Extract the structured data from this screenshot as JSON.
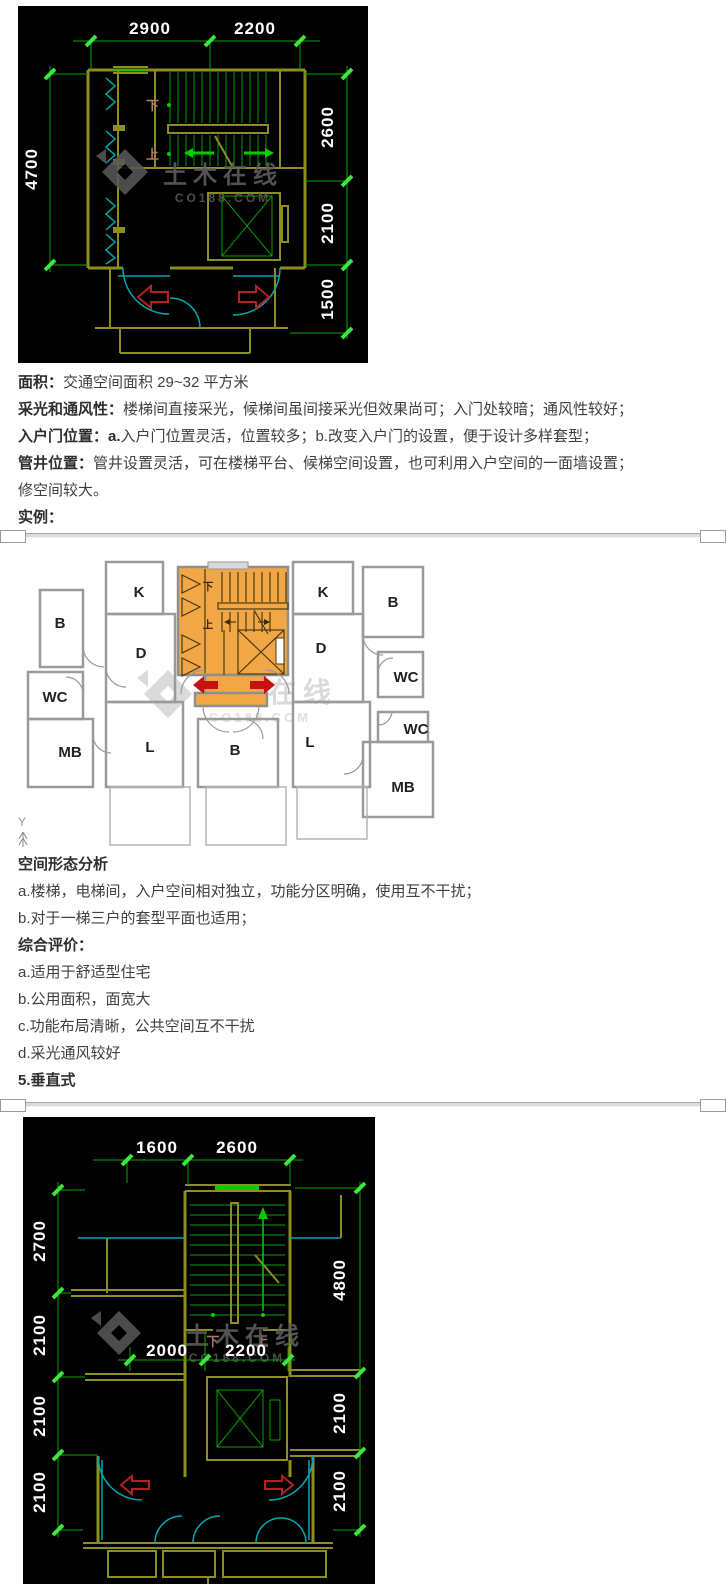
{
  "drawing_top": {
    "dims_top": [
      "2900",
      "2200"
    ],
    "dim_left": "4700",
    "dims_right": [
      "2600",
      "2100",
      "1500"
    ],
    "stair_down": "下",
    "stair_up": "上",
    "watermark_title": "土木在线",
    "watermark_domain": "CO188.COM"
  },
  "traits": {
    "lines": [
      {
        "label": "面积：",
        "text": "交通空间面积 29~32 平方米"
      },
      {
        "label": "采光和通风性：",
        "text": "楼梯间直接采光，候梯间虽间接采光但效果尚可；入门处较暗；通风性较好；"
      },
      {
        "label": "入户门位置：a.",
        "text": "入户门位置灵活，位置较多；b.改变入户门的设置，便于设计多样套型；"
      },
      {
        "label": "管井位置：",
        "text": "管井设置灵活，可在楼梯平台、候梯空间设置，也可利用入户空间的一面墙设置；"
      },
      {
        "label": "",
        "text": "修空间较大。"
      },
      {
        "label": "实例：",
        "text": ""
      }
    ]
  },
  "plan_example": {
    "room_labels": [
      "B",
      "K",
      "D",
      "WC",
      "MB",
      "L",
      "B",
      "L",
      "D",
      "K",
      "B",
      "WC",
      "WC",
      "MB"
    ],
    "stair_down": "下",
    "stair_up": "上",
    "axis_label": "Y",
    "watermark_title": "土木在线",
    "watermark_domain": "CO188.COM"
  },
  "analysis": {
    "heading": "空间形态分析",
    "items": [
      "a.楼梯，电梯间，入户空间相对独立，功能分区明确，使用互不干扰；",
      "b.对于一梯三户的套型平面也适用；"
    ],
    "heading2": "综合评价：",
    "items2": [
      "a.适用于舒适型住宅",
      "b.公用面积，面宽大",
      "c.功能布局清晰，公共空间互不干扰",
      "d.采光通风较好"
    ],
    "next_number": "5.",
    "next_title": "垂直式"
  },
  "drawing_bottom": {
    "dims_top": [
      "1600",
      "2600"
    ],
    "dims_left": [
      "2700",
      "2100",
      "2100",
      "2100"
    ],
    "dims_right": [
      "4800",
      "2100",
      "2100"
    ],
    "dims_mid": [
      "2000",
      "2200"
    ],
    "stair_down": "下",
    "stair_up": "上",
    "watermark_title": "土木在线",
    "watermark_domain": "CO188.COM"
  },
  "colors": {
    "dim_line_green": "#00a800",
    "tick_green": "#3fe53f",
    "wall_olive": "#8d8d20",
    "door_cyan": "#00a8b0",
    "arrow_red_outline": "#b22222",
    "arrow_red_solid": "#c41212",
    "core_orange": "#f2a746",
    "dim_text_white": "#ffffff",
    "plan_wall_gray": "#9a9a9a",
    "watermark_gray": "#575757"
  }
}
